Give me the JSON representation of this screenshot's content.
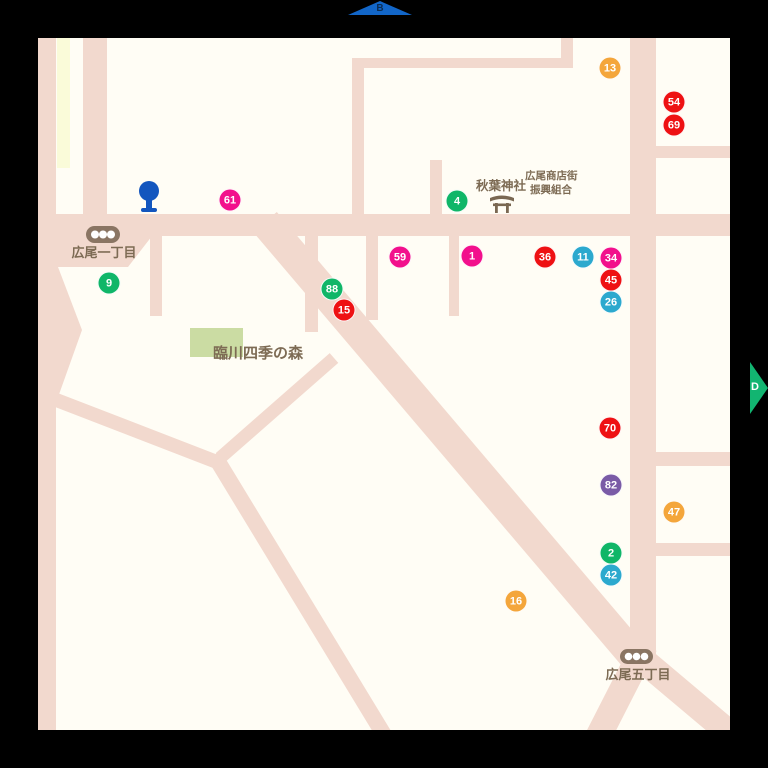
{
  "page": {
    "background": "#000000"
  },
  "map": {
    "canvas_color": "#FFFDF5",
    "road_color": "#F2D9CE",
    "park_color": "#CBDCA3",
    "field_color": "#FAFBD9",
    "label_color": "#7D6B54",
    "landmarks": {
      "park_label": "臨川四季の森",
      "shrine_label": "秋葉神社",
      "association_label_line1": "広尾商店街",
      "association_label_line2": "振興組合",
      "intersection_northwest_label": "広尾一丁目",
      "intersection_southeast_label": "広尾五丁目"
    },
    "icons": {
      "bus_stop_color": "#1356BE",
      "traffic_light_color": "#8A7563",
      "torii_color": "#7A6852"
    },
    "nav_arrows": {
      "top": {
        "label": "B",
        "color": "#1266C8",
        "label_color": "#0A2C52"
      },
      "right": {
        "label": "D",
        "color": "#12B571",
        "label_color": "#FFFFFF"
      }
    },
    "marker_palette": {
      "pink": "#F2108C",
      "red": "#EE1113",
      "green": "#10B668",
      "cyan": "#2CA9CE",
      "orange": "#F4A63B",
      "purple": "#7A5BA6"
    },
    "markers": [
      {
        "num": "13",
        "color": "orange",
        "x": 610,
        "y": 68
      },
      {
        "num": "54",
        "color": "red",
        "x": 674,
        "y": 102
      },
      {
        "num": "69",
        "color": "red",
        "x": 674,
        "y": 125
      },
      {
        "num": "61",
        "color": "pink",
        "x": 230,
        "y": 200
      },
      {
        "num": "4",
        "color": "green",
        "x": 457,
        "y": 201
      },
      {
        "num": "9",
        "color": "green",
        "x": 109,
        "y": 283
      },
      {
        "num": "59",
        "color": "pink",
        "x": 400,
        "y": 257
      },
      {
        "num": "1",
        "color": "pink",
        "x": 472,
        "y": 256
      },
      {
        "num": "36",
        "color": "red",
        "x": 545,
        "y": 257
      },
      {
        "num": "11",
        "color": "cyan",
        "x": 583,
        "y": 257
      },
      {
        "num": "34",
        "color": "pink",
        "x": 611,
        "y": 258
      },
      {
        "num": "45",
        "color": "red",
        "x": 611,
        "y": 280
      },
      {
        "num": "26",
        "color": "cyan",
        "x": 611,
        "y": 302
      },
      {
        "num": "88",
        "color": "green",
        "x": 332,
        "y": 289
      },
      {
        "num": "15",
        "color": "red",
        "x": 344,
        "y": 310
      },
      {
        "num": "70",
        "color": "red",
        "x": 610,
        "y": 428
      },
      {
        "num": "82",
        "color": "purple",
        "x": 611,
        "y": 485
      },
      {
        "num": "47",
        "color": "orange",
        "x": 674,
        "y": 512
      },
      {
        "num": "2",
        "color": "green",
        "x": 611,
        "y": 553
      },
      {
        "num": "42",
        "color": "cyan",
        "x": 611,
        "y": 575
      },
      {
        "num": "16",
        "color": "orange",
        "x": 516,
        "y": 601
      }
    ]
  }
}
